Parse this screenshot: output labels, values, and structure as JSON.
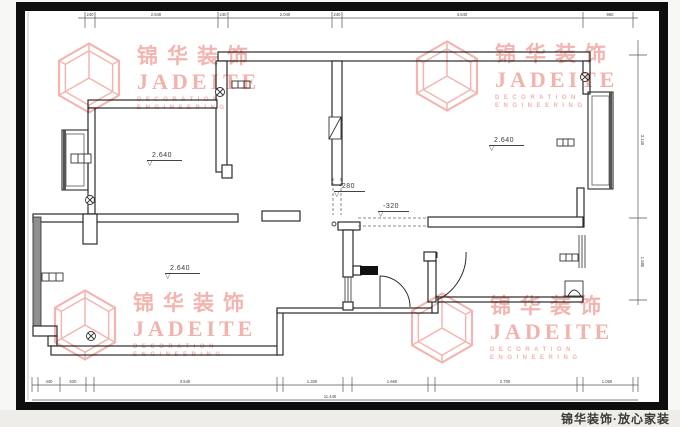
{
  "page": {
    "background": "#f7f7f5",
    "drawing_border_color": "#0e0e0e"
  },
  "footer": {
    "slogan": "锦华装饰·放心家装"
  },
  "watermark": {
    "brand_cn": "锦华装饰",
    "brand_en": "JADEITE",
    "sub_line1": "DECORATION",
    "sub_line2": "ENGINEERING",
    "color": "#f0a29b"
  },
  "plan": {
    "levels": {
      "bedroom": "2.640",
      "master": "2.640",
      "living": "2.640",
      "entry_drop": "-280",
      "hall_drop": "-320"
    },
    "icons": {
      "level_triangle": "▽"
    },
    "dims": {
      "top": [
        "240",
        "2.540",
        "240",
        "2.040",
        "240",
        "4.640",
        "960"
      ],
      "bottom": [
        "440",
        "520",
        "3.540",
        "1.300",
        "1.660",
        "2.700",
        "1.060"
      ],
      "bottom_total": "11.440",
      "right": [
        "3.140",
        "1.580"
      ]
    },
    "colors": {
      "wall": "#2b2b2b",
      "threshold": "#111111",
      "window_gray": "#8f8f8f"
    }
  }
}
